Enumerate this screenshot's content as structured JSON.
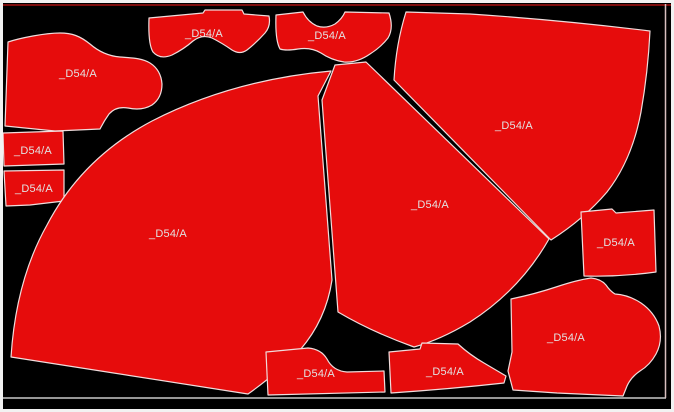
{
  "app": {
    "view": "marker-nesting-preview"
  },
  "theme": {
    "background": "#000000",
    "frame_border": "#f2f2f2",
    "piece_fill": "#e60c0c",
    "piece_outline": "#f0dcdc",
    "label_color": "#e2e2e2",
    "marker_top_line": "#7d0c0c",
    "marker_bottom_line": "#c9c9c9",
    "marker_right_line": "#d8bfbf"
  },
  "marker": {
    "pieces": [
      {
        "id": "top-left-bodice",
        "label": "_D54/A",
        "label_x": 78,
        "label_y": 77
      },
      {
        "id": "top-yoke",
        "label": "_D54/A",
        "label_x": 204,
        "label_y": 37
      },
      {
        "id": "top-collar",
        "label": "_D54/A",
        "label_x": 327,
        "label_y": 39
      },
      {
        "id": "left-rect-1",
        "label": "_D54/A",
        "label_x": 33,
        "label_y": 154
      },
      {
        "id": "left-rect-2",
        "label": "_D54/A",
        "label_x": 34,
        "label_y": 192
      },
      {
        "id": "big-left-fan",
        "label": "_D54/A",
        "label_x": 168,
        "label_y": 237
      },
      {
        "id": "middle-fan",
        "label": "_D54/A",
        "label_x": 430,
        "label_y": 208
      },
      {
        "id": "right-fan",
        "label": "_D54/A",
        "label_x": 514,
        "label_y": 129
      },
      {
        "id": "right-square",
        "label": "_D54/A",
        "label_x": 616,
        "label_y": 246
      },
      {
        "id": "bottom-mid-small",
        "label": "_D54/A",
        "label_x": 316,
        "label_y": 377
      },
      {
        "id": "bottom-right-small",
        "label": "_D54/A",
        "label_x": 445,
        "label_y": 375
      },
      {
        "id": "bottom-right-bodice",
        "label": "_D54/A",
        "label_x": 566,
        "label_y": 341
      }
    ]
  }
}
